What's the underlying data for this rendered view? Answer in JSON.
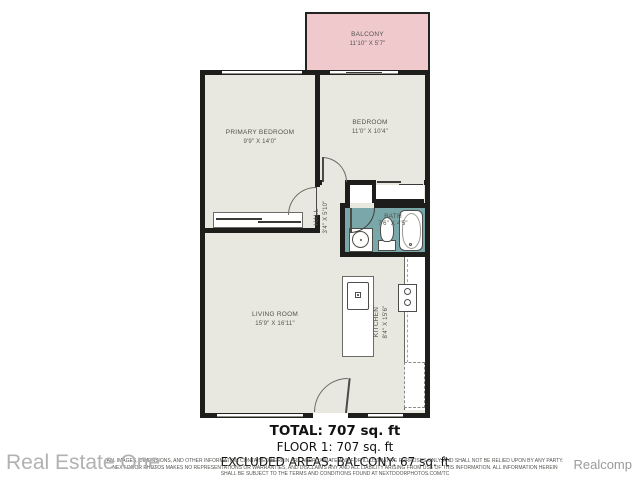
{
  "rooms": {
    "balcony": {
      "name": "BALCONY",
      "dims": "11'10\" X 5'7\""
    },
    "primary_bedroom": {
      "name": "PRIMARY BEDROOM",
      "dims": "9'9\" X 14'0\""
    },
    "bedroom": {
      "name": "BEDROOM",
      "dims": "11'0\" X 10'4\""
    },
    "hall": {
      "name": "HALL",
      "dims": "3'4\" X 5'10\""
    },
    "bath": {
      "name": "BATH",
      "dims": "7'6\" X 4'5\""
    },
    "living_room": {
      "name": "LIVING ROOM",
      "dims": "15'9\" X 16'11\""
    },
    "kitchen": {
      "name": "KITCHEN",
      "dims": "8'4\" X 15'6\""
    }
  },
  "summary": {
    "total": "TOTAL: 707 sq. ft",
    "floor1": "FLOOR 1: 707 sq. ft",
    "excluded": "EXCLUDED AREAS: BALCONY: 67 sq. ft"
  },
  "disclaimer": {
    "line1": "ALL IMAGES, DIMENSIONS, AND OTHER INFORMATION CONTAINED HEREIN ARE APPROXIMATE AND FOR ILLUSTRATIVE PURPOSES ONLY, AND SHALL NOT BE RELIED UPON BY ANY PARTY.",
    "line2": "NEXT DOOR PHOTOS MAKES NO REPRESENTATIONS OR WARRANTIES, AND DISCLAIMS ANY AND ALL LIABILITY ARISING FROM USE OF THIS INFORMATION. ALL INFORMATION HEREIN",
    "line3": "SHALL BE SUBJECT TO THE TERMS AND CONDITIONS FOUND AT NEXTDOORPHOTOS.COM/TC"
  },
  "watermarks": {
    "bottom_left": "Real Estate One",
    "bottom_right": "Realcomp"
  },
  "colors": {
    "wall": "#1d1d1b",
    "floor": "#e9e8e0",
    "balcony_floor": "#f0c9cd",
    "bath_floor": "#79a7aa",
    "label_text": "#53534c",
    "watermark": "#b1b1b1"
  }
}
